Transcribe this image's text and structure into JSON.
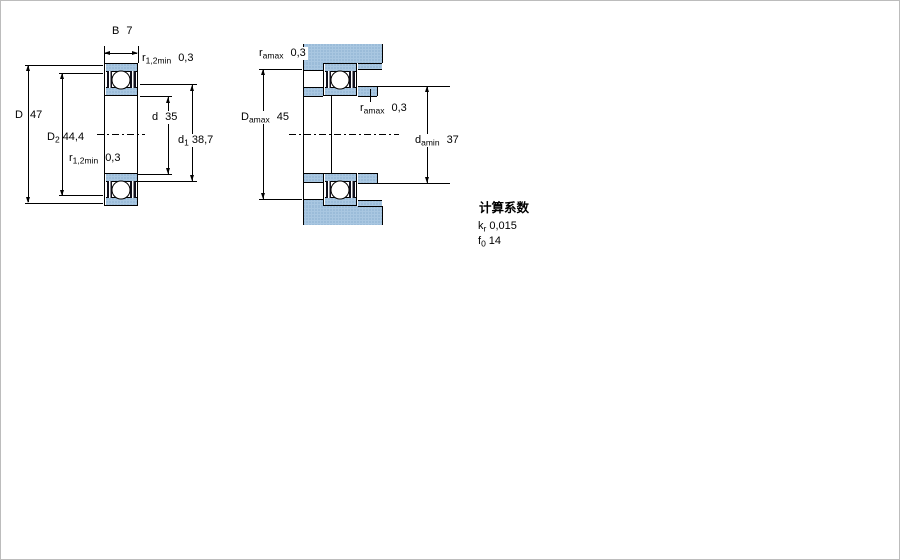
{
  "figure1": {
    "label_B": {
      "main": "B",
      "sub": "",
      "value": "7"
    },
    "label_r_top": {
      "main": "r",
      "sub": "1,2min",
      "value": "0,3"
    },
    "label_D": {
      "main": "D",
      "sub": "",
      "value": "47"
    },
    "label_D2": {
      "main": "D",
      "sub": "2",
      "value": "44,4"
    },
    "label_r_bottom": {
      "main": "r",
      "sub": "1,2min",
      "value": "0,3"
    },
    "label_d": {
      "main": "d",
      "sub": "",
      "value": "35"
    },
    "label_d1": {
      "main": "d",
      "sub": "1",
      "value": "38,7"
    }
  },
  "figure2": {
    "label_ra_top": {
      "main": "r",
      "sub": "amax",
      "value": "0,3"
    },
    "label_Damax": {
      "main": "D",
      "sub": "amax",
      "value": "45"
    },
    "label_ra_mid": {
      "main": "r",
      "sub": "amax",
      "value": "0,3"
    },
    "label_damin": {
      "main": "d",
      "sub": "amin",
      "value": "37"
    }
  },
  "calculation_factors": {
    "title": "计算系数",
    "kr": {
      "main": "k",
      "sub": "r",
      "value": "0,015"
    },
    "f0": {
      "main": "f",
      "sub": "0",
      "value": "14"
    }
  },
  "colors": {
    "section_fill": "#a9c7e1",
    "section_dot": "#7aa3c6",
    "line": "#000000",
    "seal": "#10101c"
  }
}
